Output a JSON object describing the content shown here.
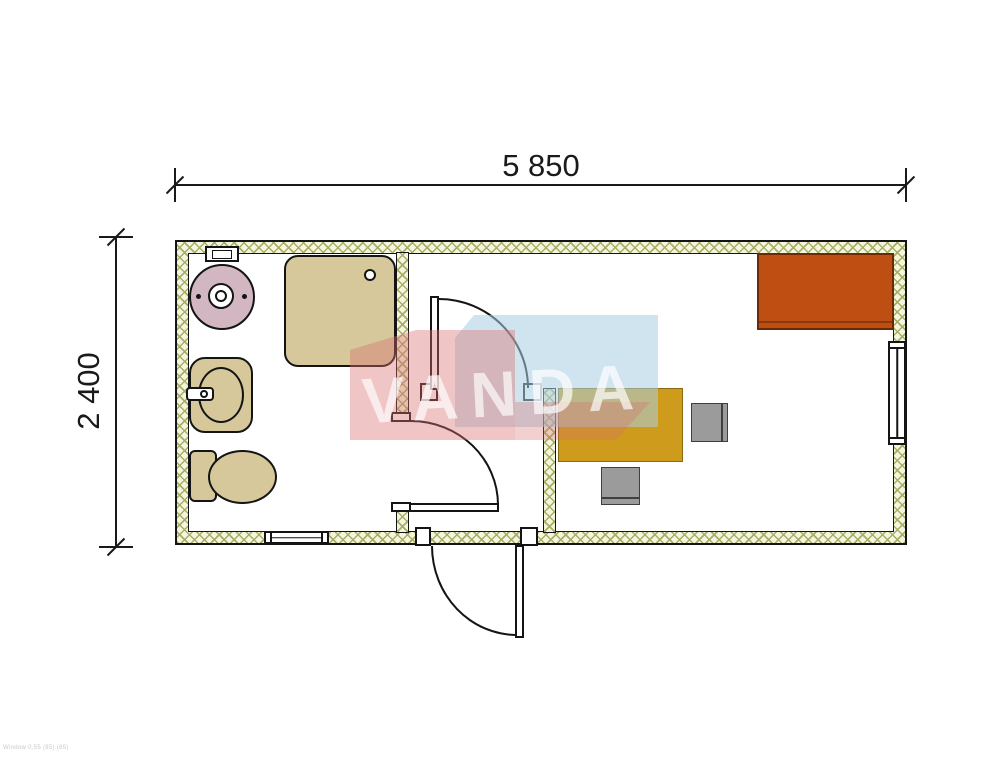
{
  "dimensions": {
    "width_label": "5 850",
    "height_label": "2 400"
  },
  "watermark": {
    "text": "VANDA",
    "blue_color": "#aacde1",
    "pink_color": "#d76e6e",
    "letter_color": "#ffffff"
  },
  "footer": {
    "note": "Window 0,55 (85) (85)"
  },
  "colors": {
    "wall_hatch_bg": "#f4f5df",
    "wall_hatch_line": "#a9ae67",
    "drawing_outline": "#141414",
    "fixture_tan": "#d6c89b",
    "water_heater_pink": "#d2b6c1",
    "desk_gold": "#cf9b1d",
    "cabinet_rust": "#bf4e12",
    "chair_gray": "#9b9b9b"
  },
  "elements": [
    {
      "name": "water-heater",
      "room": "bathroom"
    },
    {
      "name": "shower-tray",
      "room": "bathroom"
    },
    {
      "name": "washbasin",
      "room": "bathroom"
    },
    {
      "name": "toilet",
      "room": "bathroom"
    },
    {
      "name": "bathroom-window",
      "room": "bathroom"
    },
    {
      "name": "bathroom-door",
      "room": "bathroom"
    },
    {
      "name": "entrance-door",
      "room": "vestibule"
    },
    {
      "name": "office-door",
      "room": "office"
    },
    {
      "name": "desk",
      "room": "office"
    },
    {
      "name": "desk-chair",
      "room": "office"
    },
    {
      "name": "visitor-chair",
      "room": "office"
    },
    {
      "name": "cabinet",
      "room": "office"
    },
    {
      "name": "office-window",
      "room": "office"
    }
  ]
}
